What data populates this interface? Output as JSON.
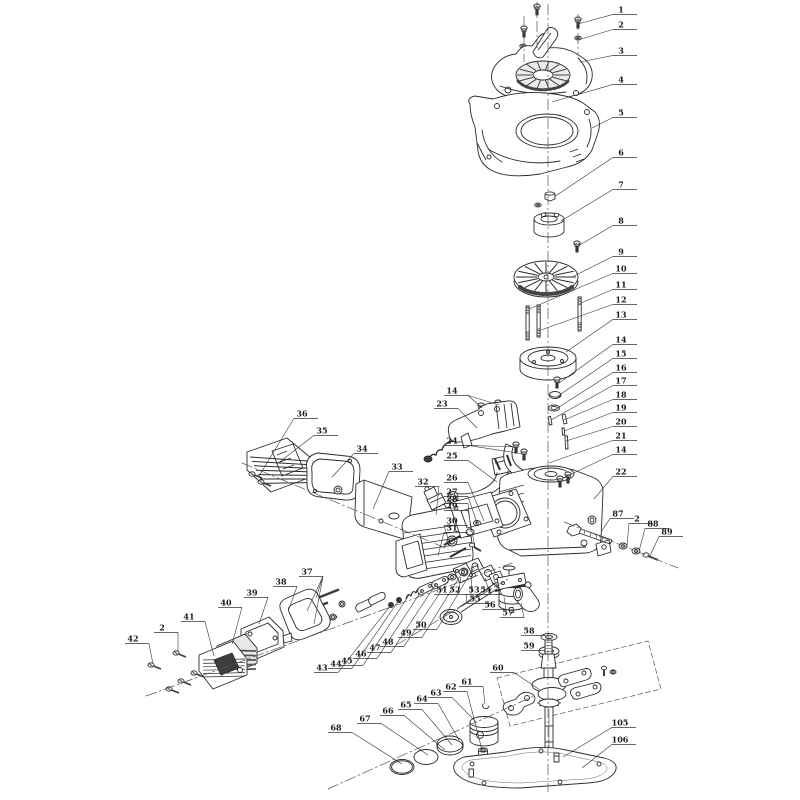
{
  "canvas": {
    "width": 800,
    "height": 800,
    "background": "#ffffff"
  },
  "style": {
    "line_color": "#2b2b2b",
    "dark_fill": "#3d3d3d",
    "shade_stroke": "#444444",
    "light_fill": "#ffffff",
    "panel_fill": "#ececec",
    "callout_color": "#1a1a1a",
    "callout_line_color": "#333333",
    "centerline_color": "#555555",
    "callout_font_size": 8
  },
  "callouts": [
    {
      "n": "1",
      "x": 621,
      "y": 10,
      "t": [
        [
          578,
          24
        ]
      ]
    },
    {
      "n": "2",
      "x": 621,
      "y": 25,
      "t": [
        [
          578,
          40
        ]
      ]
    },
    {
      "n": "3",
      "x": 621,
      "y": 51,
      "t": [
        [
          580,
          62
        ]
      ]
    },
    {
      "n": "4",
      "x": 621,
      "y": 80,
      "t": [
        [
          552,
          102
        ]
      ]
    },
    {
      "n": "5",
      "x": 621,
      "y": 113,
      "t": [
        [
          592,
          128
        ]
      ]
    },
    {
      "n": "6",
      "x": 621,
      "y": 153,
      "t": [
        [
          554,
          197
        ]
      ]
    },
    {
      "n": "7",
      "x": 621,
      "y": 185,
      "t": [
        [
          561,
          221
        ]
      ]
    },
    {
      "n": "8",
      "x": 621,
      "y": 221,
      "t": [
        [
          578,
          246
        ]
      ]
    },
    {
      "n": "9",
      "x": 621,
      "y": 252,
      "t": [
        [
          572,
          277
        ]
      ]
    },
    {
      "n": "10",
      "x": 621,
      "y": 269,
      "t": [
        [
          529,
          309
        ]
      ]
    },
    {
      "n": "11",
      "x": 621,
      "y": 285,
      "t": [
        [
          581,
          303
        ]
      ]
    },
    {
      "n": "12",
      "x": 621,
      "y": 300,
      "t": [
        [
          541,
          330
        ]
      ]
    },
    {
      "n": "13",
      "x": 621,
      "y": 315,
      "t": [
        [
          566,
          352
        ]
      ]
    },
    {
      "n": "14",
      "x": 621,
      "y": 340,
      "t": [
        [
          559,
          383
        ]
      ]
    },
    {
      "n": "15",
      "x": 621,
      "y": 354,
      "t": [
        [
          558,
          396
        ]
      ]
    },
    {
      "n": "16",
      "x": 621,
      "y": 368,
      "t": [
        [
          556,
          409
        ]
      ]
    },
    {
      "n": "17",
      "x": 621,
      "y": 381,
      "t": [
        [
          551,
          420
        ]
      ]
    },
    {
      "n": "18",
      "x": 621,
      "y": 395,
      "t": [
        [
          564,
          420
        ]
      ]
    },
    {
      "n": "19",
      "x": 621,
      "y": 408,
      "t": [
        [
          564,
          431
        ]
      ]
    },
    {
      "n": "20",
      "x": 621,
      "y": 422,
      "t": [
        [
          566,
          441
        ]
      ]
    },
    {
      "n": "21",
      "x": 621,
      "y": 436,
      "t": [
        [
          549,
          463
        ]
      ]
    },
    {
      "n": "14",
      "x": 621,
      "y": 450,
      "t": [
        [
          563,
          478
        ]
      ]
    },
    {
      "n": "22",
      "x": 621,
      "y": 472,
      "t": [
        [
          594,
          499
        ]
      ]
    },
    {
      "n": "14",
      "x": 452,
      "y": 391,
      "t": [
        [
          482,
          408
        ],
        [
          499,
          405
        ]
      ]
    },
    {
      "n": "23",
      "x": 442,
      "y": 404,
      "t": [
        [
          477,
          428
        ]
      ]
    },
    {
      "n": "24",
      "x": 452,
      "y": 441,
      "t": [
        [
          517,
          447
        ],
        [
          524,
          454
        ]
      ]
    },
    {
      "n": "25",
      "x": 452,
      "y": 456,
      "t": [
        [
          497,
          482
        ]
      ]
    },
    {
      "n": "26",
      "x": 452,
      "y": 478,
      "t": [
        [
          484,
          521
        ]
      ]
    },
    {
      "n": "27",
      "x": 452,
      "y": 492,
      "t": [
        [
          477,
          523
        ]
      ]
    },
    {
      "n": "28",
      "x": 452,
      "y": 499,
      "t": [
        [
          471,
          532
        ]
      ]
    },
    {
      "n": "29",
      "x": 452,
      "y": 506,
      "t": [
        [
          475,
          547
        ]
      ]
    },
    {
      "n": "30",
      "x": 452,
      "y": 521,
      "t": [
        [
          450,
          545
        ]
      ]
    },
    {
      "n": "31",
      "x": 452,
      "y": 528,
      "t": [
        [
          438,
          556
        ]
      ]
    },
    {
      "n": "32",
      "x": 423,
      "y": 482,
      "t": [
        [
          436,
          515
        ]
      ]
    },
    {
      "n": "33",
      "x": 397,
      "y": 467,
      "t": [
        [
          373,
          509
        ]
      ]
    },
    {
      "n": "34",
      "x": 362,
      "y": 449,
      "t": [
        [
          332,
          477
        ]
      ]
    },
    {
      "n": "35",
      "x": 322,
      "y": 431,
      "t": [
        [
          277,
          464
        ]
      ]
    },
    {
      "n": "36",
      "x": 302,
      "y": 414,
      "t": [
        [
          259,
          476
        ]
      ]
    },
    {
      "n": "37",
      "x": 307,
      "y": 572,
      "t": [
        [
          316,
          598
        ],
        [
          307,
          611
        ],
        [
          314,
          624
        ]
      ]
    },
    {
      "n": "38",
      "x": 281,
      "y": 582,
      "t": [
        [
          289,
          609
        ]
      ]
    },
    {
      "n": "39",
      "x": 252,
      "y": 593,
      "t": [
        [
          259,
          624
        ]
      ]
    },
    {
      "n": "40",
      "x": 226,
      "y": 603,
      "t": [
        [
          232,
          644
        ]
      ]
    },
    {
      "n": "41",
      "x": 189,
      "y": 617,
      "t": [
        [
          214,
          656
        ]
      ]
    },
    {
      "n": "2",
      "x": 162,
      "y": 628,
      "t": [
        [
          178,
          652
        ]
      ]
    },
    {
      "n": "42",
      "x": 133,
      "y": 639,
      "t": [
        [
          153,
          664
        ]
      ]
    },
    {
      "n": "43",
      "x": 322,
      "y": 668,
      "t": [
        [
          391,
          605
        ]
      ]
    },
    {
      "n": "44",
      "x": 336,
      "y": 664,
      "t": [
        [
          399,
          600
        ]
      ]
    },
    {
      "n": "45",
      "x": 347,
      "y": 661,
      "t": [
        [
          409,
          595
        ]
      ]
    },
    {
      "n": "46",
      "x": 361,
      "y": 654,
      "t": [
        [
          422,
          590
        ]
      ]
    },
    {
      "n": "47",
      "x": 375,
      "y": 648,
      "t": [
        [
          436,
          584
        ]
      ]
    },
    {
      "n": "48",
      "x": 388,
      "y": 642,
      "t": [
        [
          450,
          578
        ]
      ]
    },
    {
      "n": "49",
      "x": 406,
      "y": 633,
      "t": [
        [
          462,
          573
        ]
      ]
    },
    {
      "n": "50",
      "x": 421,
      "y": 625,
      "t": [
        [
          474,
          567
        ]
      ]
    },
    {
      "n": "51",
      "x": 442,
      "y": 590,
      "t": [
        [
          461,
          577
        ]
      ]
    },
    {
      "n": "52",
      "x": 455,
      "y": 590,
      "t": [
        [
          472,
          570
        ]
      ]
    },
    {
      "n": "53",
      "x": 474,
      "y": 590,
      "t": [
        [
          485,
          578
        ]
      ]
    },
    {
      "n": "54",
      "x": 486,
      "y": 590,
      "t": [
        [
          494,
          580
        ]
      ]
    },
    {
      "n": "55",
      "x": 475,
      "y": 599,
      "t": [
        [
          466,
          594
        ]
      ]
    },
    {
      "n": "56",
      "x": 490,
      "y": 605,
      "t": [
        [
          504,
          597
        ]
      ]
    },
    {
      "n": "57",
      "x": 508,
      "y": 613,
      "t": [
        [
          521,
          603
        ]
      ]
    },
    {
      "n": "58",
      "x": 529,
      "y": 631,
      "t": [
        [
          546,
          637
        ]
      ]
    },
    {
      "n": "59",
      "x": 529,
      "y": 646,
      "t": [
        [
          545,
          651
        ]
      ]
    },
    {
      "n": "60",
      "x": 498,
      "y": 668,
      "t": [
        [
          540,
          690
        ]
      ]
    },
    {
      "n": "61",
      "x": 467,
      "y": 682,
      "t": [
        [
          485,
          704
        ]
      ]
    },
    {
      "n": "62",
      "x": 451,
      "y": 687,
      "t": [
        [
          482,
          750
        ]
      ]
    },
    {
      "n": "63",
      "x": 436,
      "y": 693,
      "t": [
        [
          476,
          722
        ]
      ]
    },
    {
      "n": "64",
      "x": 422,
      "y": 699,
      "t": [
        [
          459,
          740
        ]
      ]
    },
    {
      "n": "65",
      "x": 406,
      "y": 705,
      "t": [
        [
          452,
          745
        ]
      ]
    },
    {
      "n": "66",
      "x": 388,
      "y": 711,
      "t": [
        [
          445,
          750
        ]
      ]
    },
    {
      "n": "67",
      "x": 365,
      "y": 719,
      "t": [
        [
          428,
          755
        ]
      ]
    },
    {
      "n": "68",
      "x": 336,
      "y": 728,
      "t": [
        [
          402,
          764
        ]
      ]
    },
    {
      "n": "87",
      "x": 618,
      "y": 514,
      "t": [
        [
          601,
          532
        ]
      ]
    },
    {
      "n": "2",
      "x": 637,
      "y": 519,
      "t": [
        [
          627,
          546
        ]
      ]
    },
    {
      "n": "88",
      "x": 653,
      "y": 524,
      "t": [
        [
          639,
          551
        ]
      ]
    },
    {
      "n": "89",
      "x": 667,
      "y": 532,
      "t": [
        [
          650,
          556
        ]
      ]
    },
    {
      "n": "105",
      "x": 620,
      "y": 723,
      "t": [
        [
          563,
          757
        ]
      ]
    },
    {
      "n": "106",
      "x": 620,
      "y": 740,
      "t": [
        [
          582,
          768
        ]
      ]
    }
  ]
}
